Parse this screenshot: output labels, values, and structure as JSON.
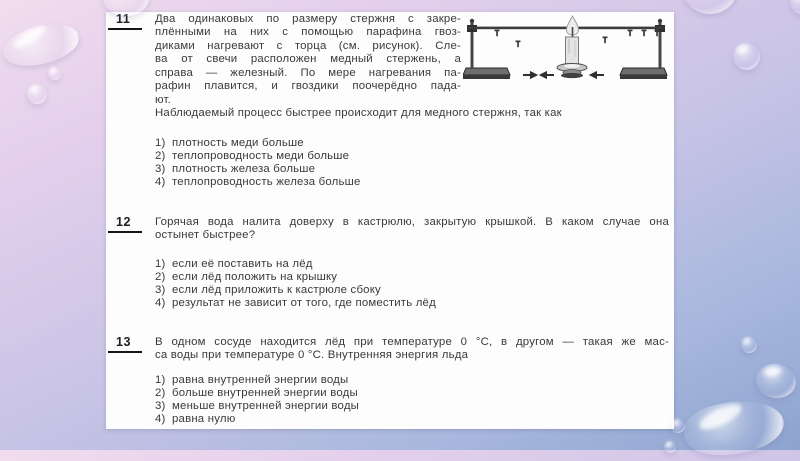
{
  "colors": {
    "background_top": "#f0ddee",
    "background_bottom": "#8da4cf",
    "paper": "#fdfdfd",
    "text": "#3a3a3a",
    "number_underline": "#161616"
  },
  "figure": {
    "parts": [
      "ring-stand-left",
      "horizontal-rod",
      "nails",
      "candle",
      "ring-stand-right",
      "airflow-arrows"
    ]
  },
  "questions": [
    {
      "number": "11",
      "lines": [
        "Два одинаковых по размеру стержня с закре-",
        "плёнными на них с помощью парафина гвоз-",
        "диками нагревают с торца (см. рисунок). Сле-",
        "ва от свечи расположен медный стержень, а",
        "справа — железный. По мере нагревания па-",
        "рафин плавится, и гвоздики поочерёдно пада-",
        "ют."
      ],
      "full_line": "Наблюдаемый процесс быстрее происходит для медного стержня, так как",
      "options": [
        {
          "num": "1)",
          "text": "плотность меди больше"
        },
        {
          "num": "2)",
          "text": "теплопроводность меди больше"
        },
        {
          "num": "3)",
          "text": "плотность железа больше"
        },
        {
          "num": "4)",
          "text": "теплопроводность железа больше"
        }
      ]
    },
    {
      "number": "12",
      "lines": [
        "Горячая вода налита доверху в кастрюлю, закрытую крышкой. В каком случае она",
        "остынет быстрее?"
      ],
      "options": [
        {
          "num": "1)",
          "text": "если её поставить на лёд"
        },
        {
          "num": "2)",
          "text": "если лёд положить на крышку"
        },
        {
          "num": "3)",
          "text": "если лёд приложить к кастрюле сбоку"
        },
        {
          "num": "4)",
          "text": "результат не зависит от того, где поместить лёд"
        }
      ]
    },
    {
      "number": "13",
      "lines": [
        "В одном сосуде находится лёд при температуре 0 °C, в другом — такая же мас-",
        "са воды при температуре 0 °C. Внутренняя энергия льда"
      ],
      "options": [
        {
          "num": "1)",
          "text": "равна внутренней энергии воды"
        },
        {
          "num": "2)",
          "text": "больше внутренней энергии воды"
        },
        {
          "num": "3)",
          "text": "меньше внутренней энергии воды"
        },
        {
          "num": "4)",
          "text": "равна нулю"
        }
      ]
    }
  ]
}
